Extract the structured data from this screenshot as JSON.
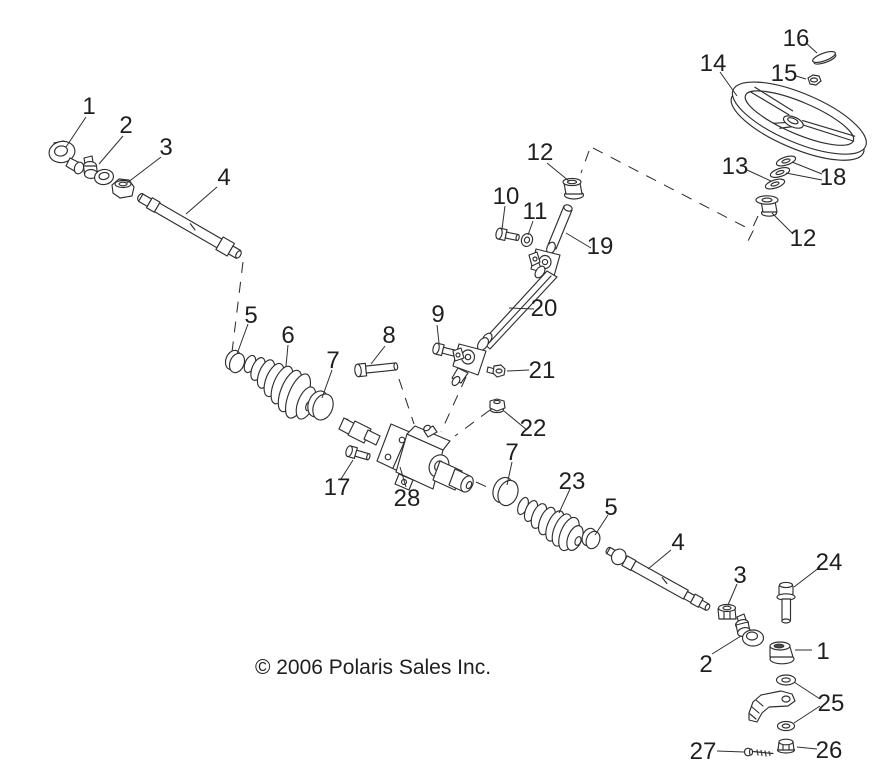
{
  "page": {
    "copyright": "© 2006 Polaris Sales Inc.",
    "background_color": "#ffffff",
    "line_color": "#2f2f2f",
    "text_color": "#1f1f1f"
  },
  "callouts": {
    "n1_left": "1",
    "n2_left": "2",
    "n3_left": "3",
    "n4_left": "4",
    "n5_left": "5",
    "n6": "6",
    "n7_left": "7",
    "n8": "8",
    "n9": "9",
    "n10": "10",
    "n11": "11",
    "n12_column": "12",
    "n12_wheel": "12",
    "n13": "13",
    "n14": "14",
    "n15": "15",
    "n16": "16",
    "n17": "17",
    "n18": "18",
    "n19": "19",
    "n20": "20",
    "n21": "21",
    "n22": "22",
    "n23": "23",
    "n24": "24",
    "n25": "25",
    "n26": "26",
    "n27": "27",
    "n28": "28",
    "n7_right": "7",
    "n5_right": "5",
    "n4_right": "4",
    "n3_right": "3",
    "n2_right": "2",
    "n1_right": "1"
  }
}
